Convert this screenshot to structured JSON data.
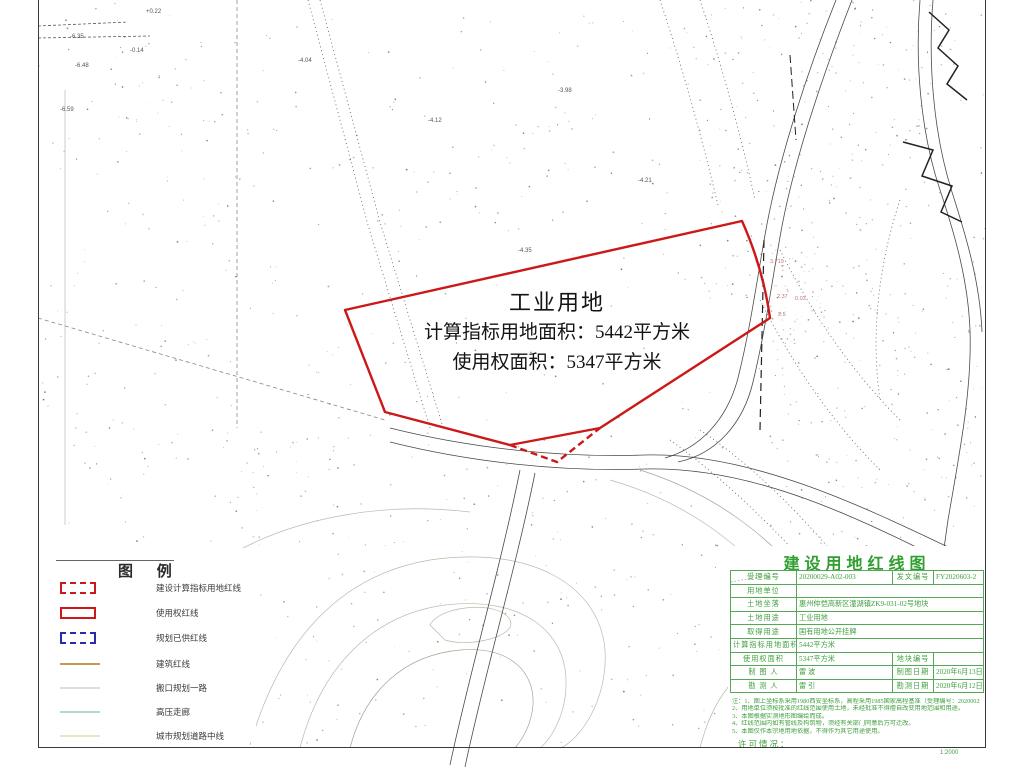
{
  "sheet": {
    "scale_label": "1:2000"
  },
  "map": {
    "parcel": {
      "title": "工业用地",
      "calc_area_line": "计算指标用地面积：5442平方米",
      "right_area_line": "使用权面积：5347平方米"
    },
    "elevation_labels": [
      "-6.35",
      "-6.48",
      "-6.59",
      "-4.04",
      "-4.12",
      "-3.98",
      "-4.21",
      "-4.35",
      "+0.22",
      "-0.14"
    ],
    "red_annotations": [
      "3.719",
      "2.37",
      "0.03",
      "2.5"
    ],
    "colors": {
      "redline": "#cc1818",
      "bluedash": "#2a2ab0",
      "titleblock_green": "#3f9f3f"
    }
  },
  "legend": {
    "title": "图 例",
    "items": [
      {
        "label": "建设计算指标用地红线",
        "symbol": "red-dashed-rect"
      },
      {
        "label": "使用权红线",
        "symbol": "red-solid-rect"
      },
      {
        "label": "规划已供红线",
        "symbol": "blue-dashed-rect"
      },
      {
        "label": "建筑红线",
        "symbol": "orange-line"
      },
      {
        "label": "搬口规划一路",
        "symbol": "gray-line"
      },
      {
        "label": "高压走廊",
        "symbol": "cyan-line"
      },
      {
        "label": "城市规划道路中线",
        "symbol": "yellow-line"
      }
    ]
  },
  "title_block": {
    "title": "建设用地红线图",
    "accept_no_label": "受理编号",
    "accept_no": "20200029-A02-003",
    "issue_no_label": "发文编号",
    "issue_no": "FY2020603-2",
    "unit_label": "用地单位",
    "unit": "",
    "location_label": "土地坐落",
    "location": "惠州仲恺高新区潼湖镇ZK9-031-02号地块",
    "use_label": "土地用途",
    "use": "工业用地",
    "obtain_label": "取得用途",
    "obtain": "国有用地公开挂牌",
    "calc_area_label": "计算指标用地面积",
    "calc_area": "5442平方米",
    "right_area_label": "使用权面积",
    "right_area": "5347平方米",
    "parcel_no_label": "地块编号",
    "parcel_no": "",
    "drafter_label": "制 图 人",
    "drafter": "雷 波",
    "draft_date_label": "制图日期",
    "draft_date": "2020年6月13日",
    "surveyor_label": "勘 测 人",
    "surveyor": "雷 引",
    "survey_date_label": "勘测日期",
    "survey_date": "2020年6月12日",
    "notes_label": "注：",
    "notes": [
      "注：1、图上坐标系采用1980西安坐标系，高程采用1985国家高程基准（受理编号：20200029）。",
      "2、用地单位须按批准的红线范围使用土地，未经批准不得擅自改变用地范围和用途。",
      "3、本图根据实测地形图编绘而成。",
      "4、红线范围内如有管线及构筑物，须经有关部门同意后方可迁改。",
      "5、本图仅作本宗地用地依据，不得作为其它用途使用。"
    ],
    "permit_label": "许可情况："
  }
}
